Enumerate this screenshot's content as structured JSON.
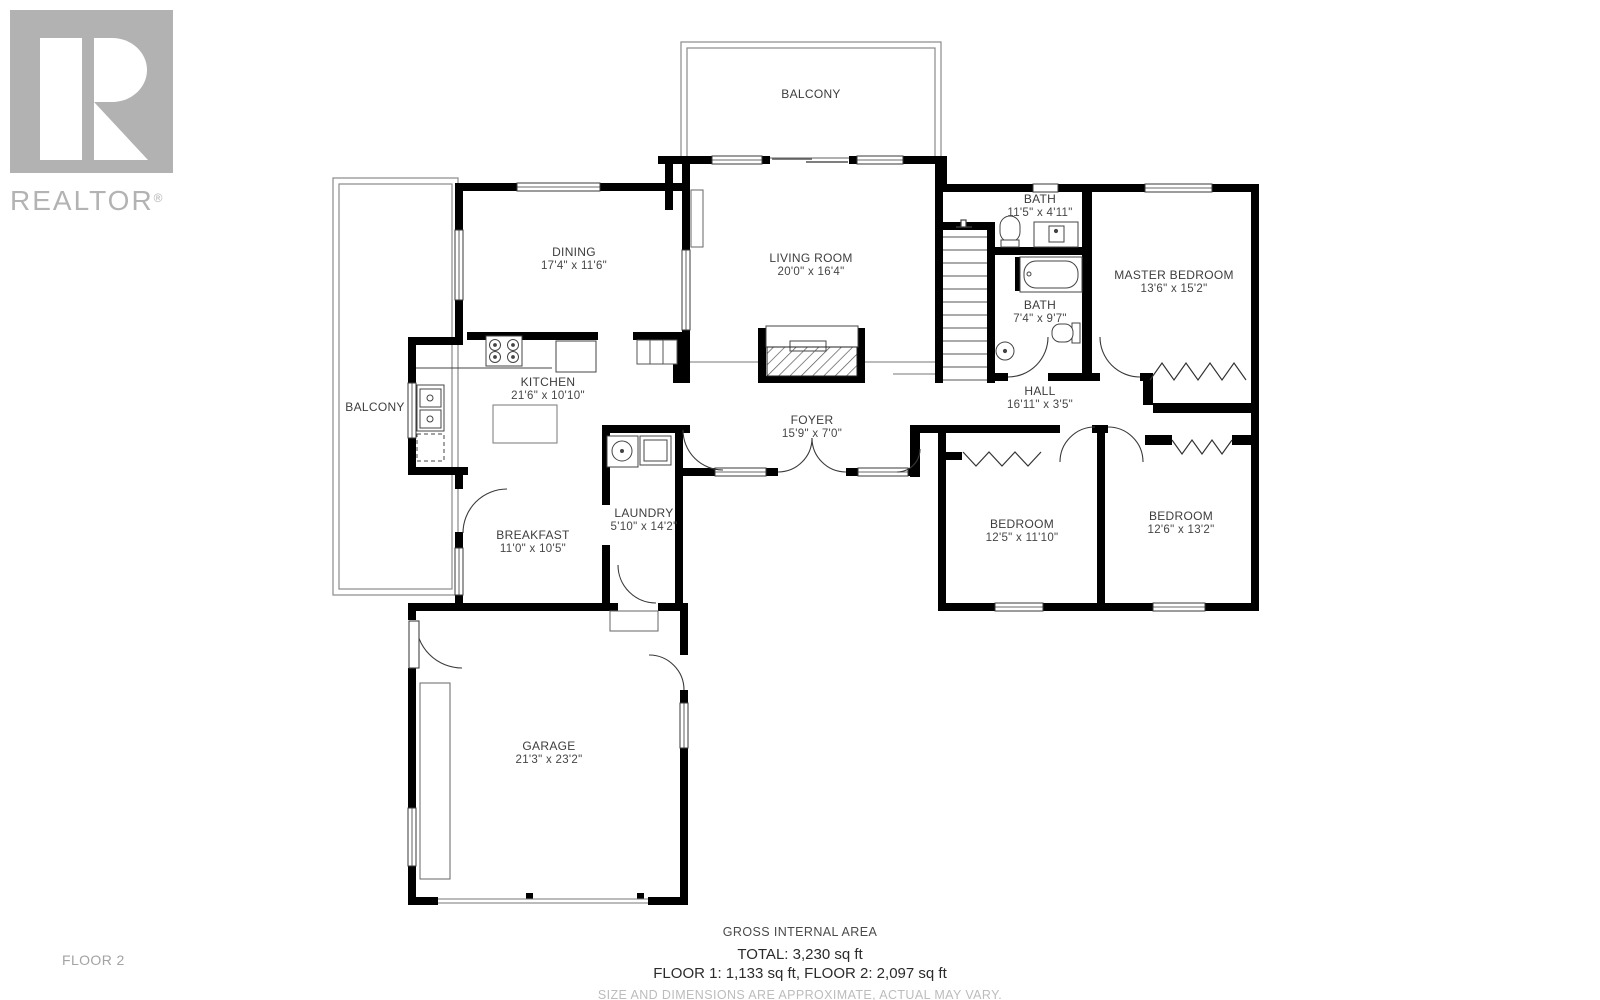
{
  "logo": {
    "brand": "REALTOR",
    "reg": "®"
  },
  "floor_label": "FLOOR 2",
  "rooms": [
    {
      "name": "BALCONY",
      "dims": ""
    },
    {
      "name": "DINING",
      "dims": "17'4\" x 11'6\""
    },
    {
      "name": "LIVING ROOM",
      "dims": "20'0\" x 16'4\""
    },
    {
      "name": "KITCHEN",
      "dims": "21'6\" x 10'10\""
    },
    {
      "name": "BALCONY",
      "dims": ""
    },
    {
      "name": "BREAKFAST",
      "dims": "11'0\" x 10'5\""
    },
    {
      "name": "LAUNDRY",
      "dims": "5'10\" x 14'2\""
    },
    {
      "name": "FOYER",
      "dims": "15'9\" x 7'0\""
    },
    {
      "name": "BATH",
      "dims": "11'5\" x 4'11\""
    },
    {
      "name": "BATH",
      "dims": "7'4\" x 9'7\""
    },
    {
      "name": "MASTER BEDROOM",
      "dims": "13'6\" x 15'2\""
    },
    {
      "name": "HALL",
      "dims": "16'11\" x 3'5\""
    },
    {
      "name": "BEDROOM",
      "dims": "12'5\" x 11'10\""
    },
    {
      "name": "BEDROOM",
      "dims": "12'6\" x 13'2\""
    },
    {
      "name": "GARAGE",
      "dims": "21'3\" x 23'2\""
    }
  ],
  "footer": {
    "gross_label": "GROSS INTERNAL AREA",
    "total": "TOTAL: 3,230 sq ft",
    "floors": "FLOOR 1: 1,133 sq ft, FLOOR 2: 2,097 sq ft",
    "disclaimer": "SIZE AND DIMENSIONS ARE APPROXIMATE, ACTUAL MAY VARY."
  },
  "colors": {
    "wall": "#000000",
    "line": "#3c3c3c",
    "label": "#3d3d3d",
    "logo_gray": "#b2b2b2",
    "muted_text": "#bcbcbc"
  }
}
